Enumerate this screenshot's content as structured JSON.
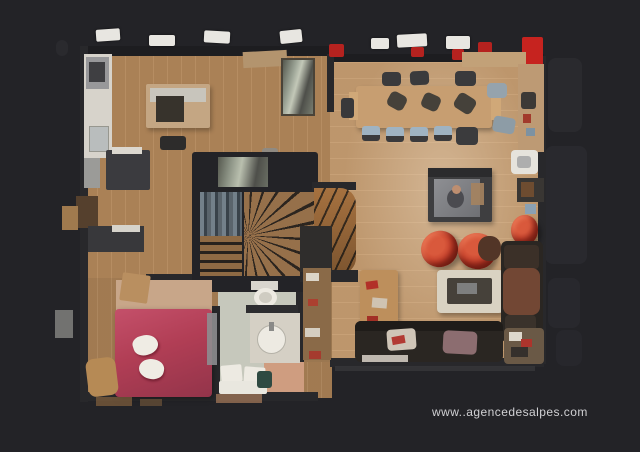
{
  "watermark": {
    "text": "www..agencedesalpes.com"
  },
  "palette": {
    "background": "#232327",
    "wall": "#28282b",
    "wood_main": "#b2875a",
    "wood_dining": "#c59c70",
    "wood_dark": "#a87f55",
    "bath_floor": "#c6c8bc",
    "bed_red": "#b13e55",
    "chair_red": "#c33b28",
    "accent_red": "#b5221f",
    "sofa_dark": "#2a2622",
    "table_cream": "#d9d2c2",
    "dining_table_tan": "#c79e71",
    "fixture_white": "#edeae2",
    "stair_wood": "#a6713f"
  }
}
